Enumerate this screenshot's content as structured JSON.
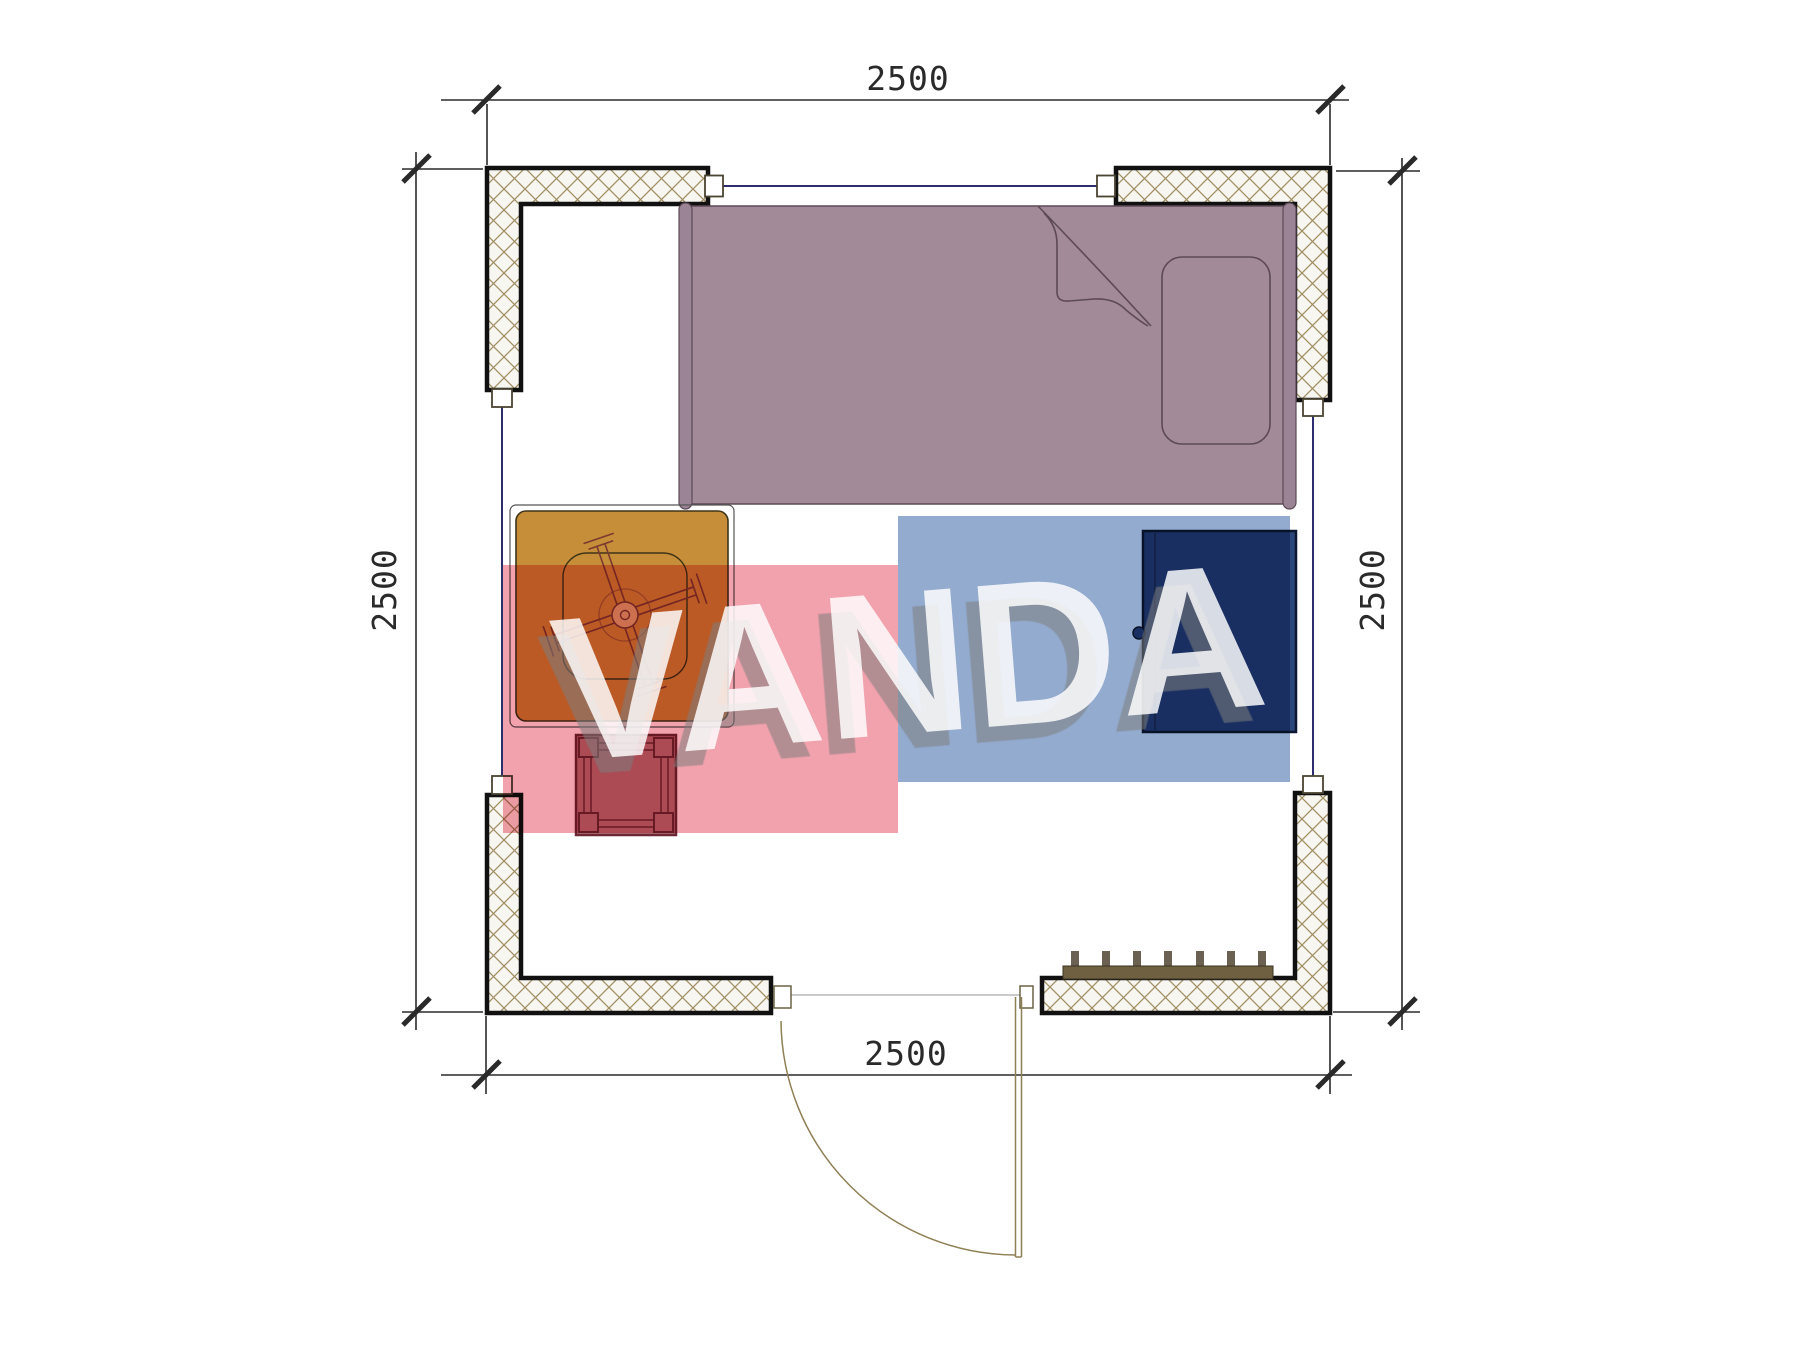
{
  "dimensions": {
    "top": "2500",
    "bottom": "2500",
    "left": "2500",
    "right": "2500"
  },
  "watermark": {
    "text": "VANDA",
    "pink_color": "#f2a2ad",
    "blue_color": "#93abce",
    "text_color": "rgba(255,255,255,0.83)",
    "shadow_color": "rgba(126,126,126,0.55)"
  },
  "colors": {
    "wall_fill": "#f8f6f1",
    "wall_hatch_line": "#a09064",
    "wall_border": "#111111",
    "window_line": "#2e2e6e",
    "window_marker_fill": "#ffffff",
    "window_marker_stroke": "#4a4432",
    "door_line": "#8f7f55",
    "dim_line": "#2a2a2a",
    "bed_fill": "#a28a98",
    "bed_rail": "#9a8495",
    "bed_outline": "#5d4a55",
    "table_fill": "#c68e38",
    "table_outline": "#3f3418",
    "chair_line": "#7a3a30",
    "stool_fill": "#b5757b",
    "stool_outline": "#6e2834",
    "wardrobe_fill": "#2b4679",
    "wardrobe_outline": "#0c1830",
    "radiator_fill": "#6e6040",
    "radiator_teeth": "#6b6152"
  }
}
